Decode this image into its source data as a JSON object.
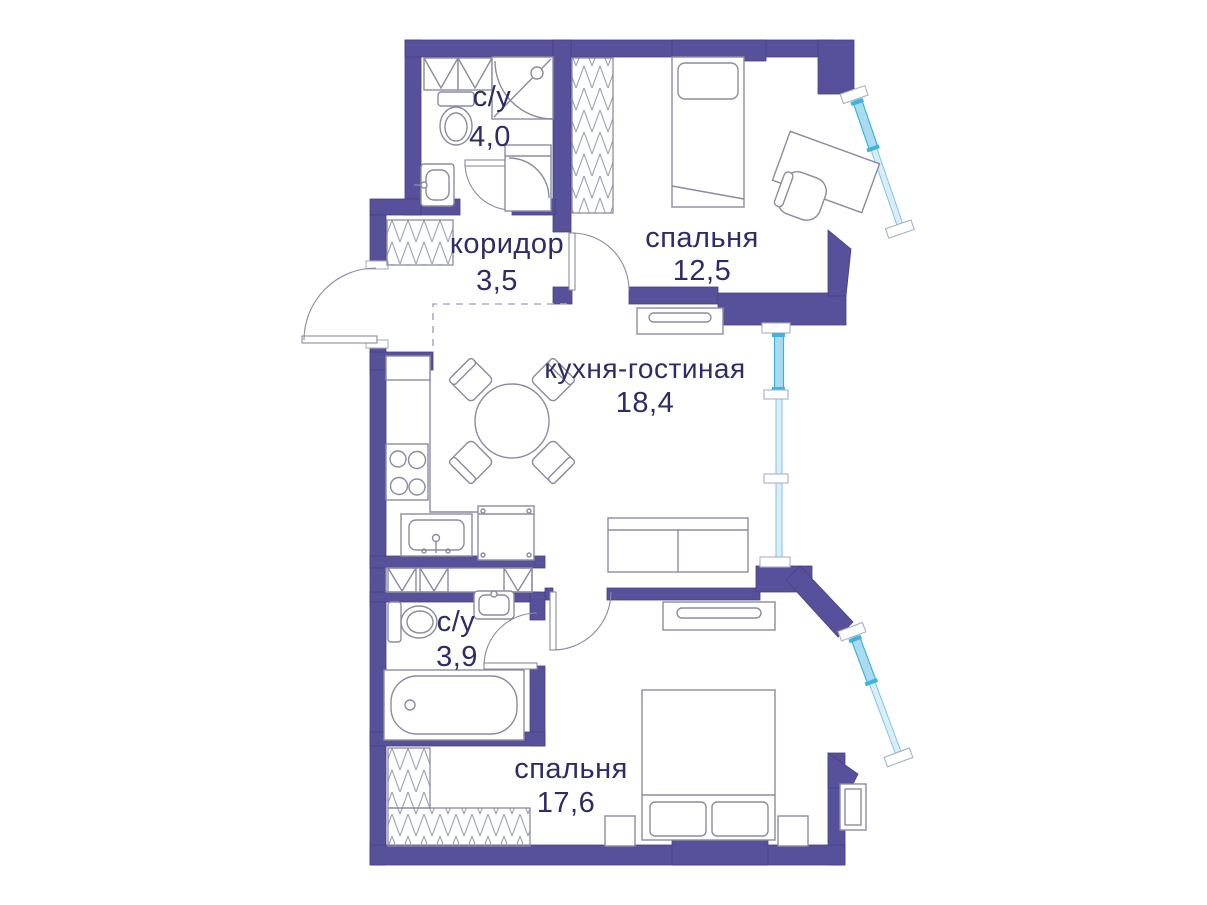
{
  "plan": {
    "type": "apartment-floor-plan",
    "colors": {
      "background": "#ffffff",
      "wall": "#57509b",
      "wall_edge": "#474084",
      "furniture_line": "#8b8ba0",
      "text": "#2f2b66",
      "window_glass": "#d8edf7",
      "window_casement": "#a9dcf0",
      "window_frame": "#7ec7e2",
      "window_accent": "#3fb3d9",
      "sill_edge": "#a9b0c6",
      "dash": "#a9aec2"
    },
    "rooms": [
      {
        "id": "bathroom-top",
        "name": "с/у",
        "area": "4,0"
      },
      {
        "id": "corridor",
        "name": "коридор",
        "area": "3,5"
      },
      {
        "id": "bedroom-top",
        "name": "спальня",
        "area": "12,5"
      },
      {
        "id": "kitchen-living",
        "name": "кухня-гостиная",
        "area": "18,4"
      },
      {
        "id": "bathroom-bottom",
        "name": "с/у",
        "area": "3,9"
      },
      {
        "id": "bedroom-bottom",
        "name": "спальня",
        "area": "17,6"
      }
    ]
  }
}
